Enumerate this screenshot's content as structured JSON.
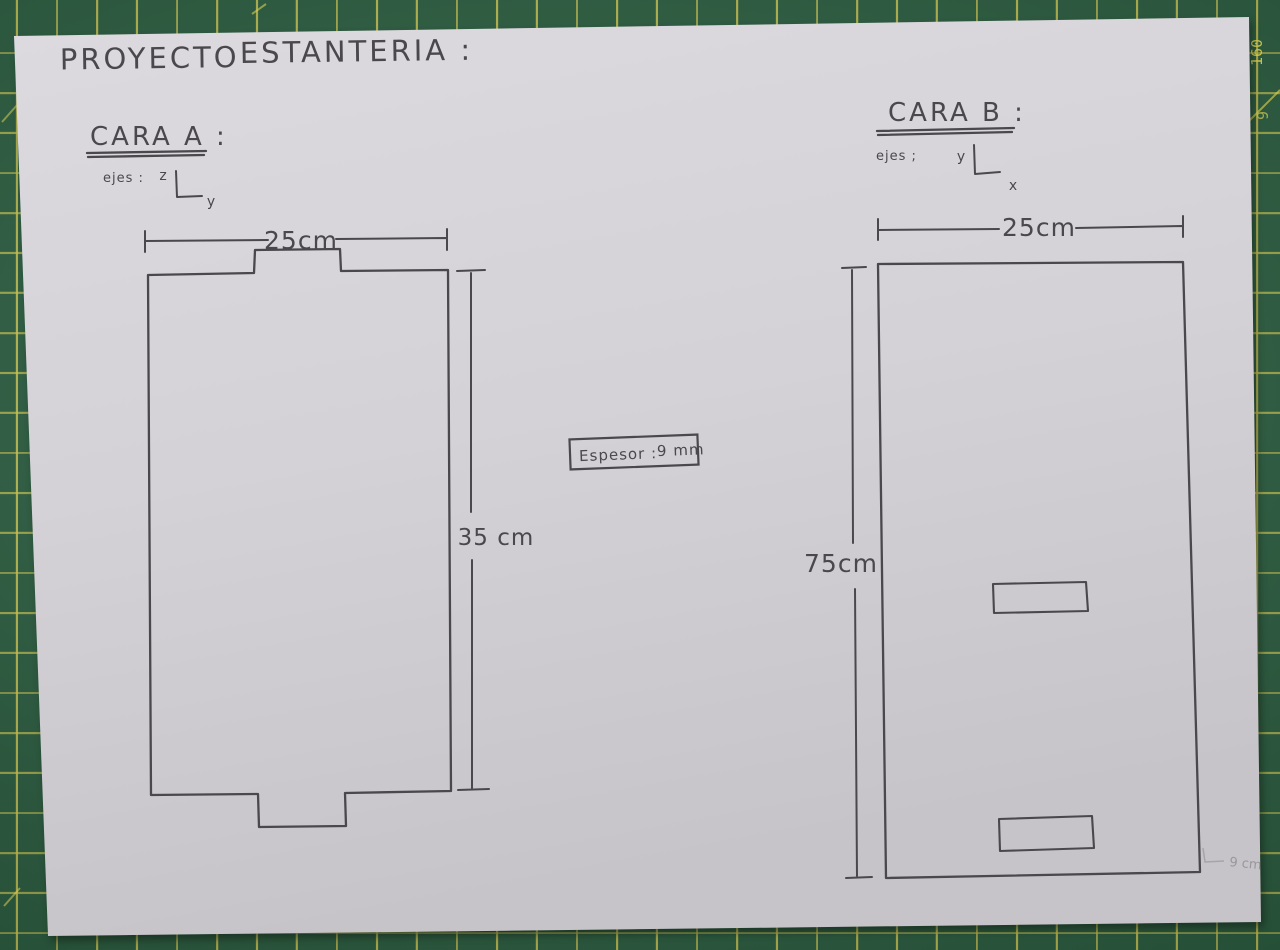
{
  "title": {
    "word1": "PROYECTO",
    "word2": "ESTANTERIA :"
  },
  "cara_a": {
    "heading": "CARA A :",
    "axes_label": "ejes :",
    "axis_up": "z",
    "axis_right": "y",
    "width_label": "25cm",
    "height_label": "35 cm"
  },
  "cara_b": {
    "heading": "CARA B :",
    "axes_label": "ejes ;",
    "axis_up": "y",
    "axis_right": "x",
    "width_label": "25cm",
    "height_label": "75cm"
  },
  "thickness_note": {
    "label": "Espesor :",
    "value": "9 mm"
  },
  "faint_note": "9 cm",
  "mat_markings": {
    "ruler_number_1": "160",
    "ruler_number_2": "9"
  },
  "colors": {
    "mat_green": "#2a5e40",
    "grid_yellow": "#d6ce52",
    "paper": "#d6d4d8",
    "pencil": "#4a484d"
  }
}
